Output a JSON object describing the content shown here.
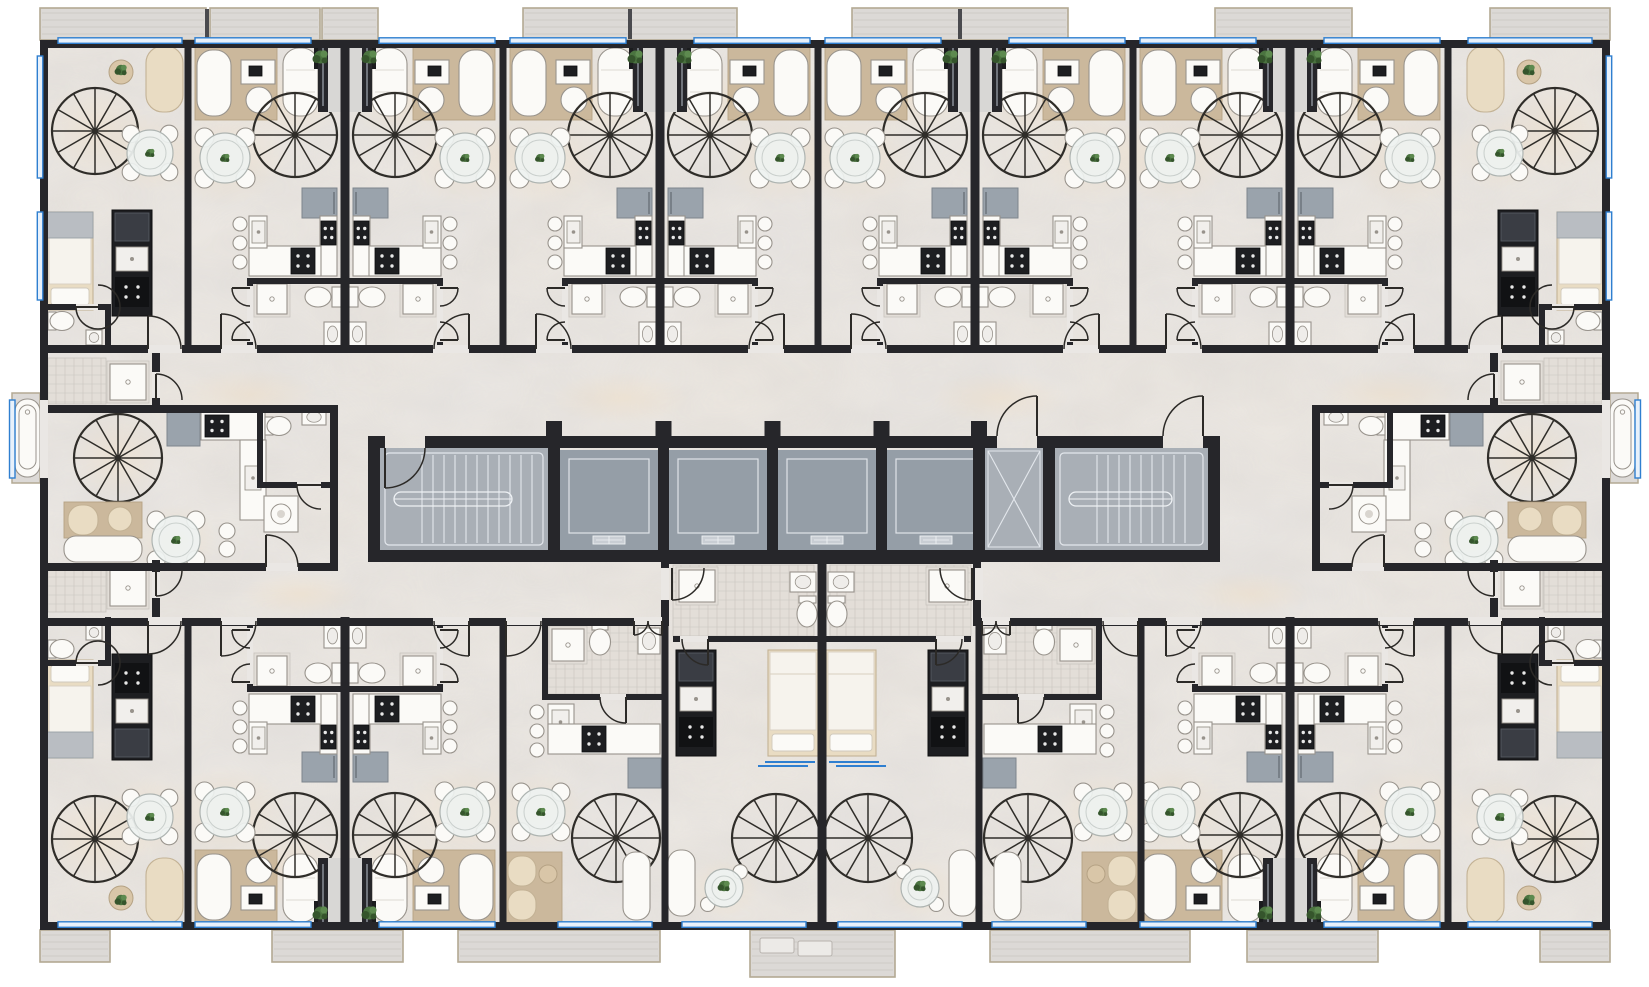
{
  "meta": {
    "domain": "architectural-floor-plan",
    "description": "Top-down 3D rendered floor plan of a residential apartment building: two wings of duplex studio units with spiral staircases, a central core with two stairwells, four elevators and a ventilation shaft, north and south corridors, perimeter balconies and two side bathtub bays",
    "text_in_image": "none"
  },
  "canvas": {
    "width": 1649,
    "height": 987
  },
  "palette": {
    "background": "#ffffff",
    "wall": "#26262a",
    "wall_light": "#3a3d44",
    "floor": "#eae7e4",
    "floor_warm": "#f2dfc4",
    "core_floor": "#a9afb6",
    "cab_floor": "#959ea7",
    "stair_tread": "#e3e7ec",
    "window_blue": "#2f7fd0",
    "window_fill": "#e8f1fb",
    "balcony_slab": "#dcd9d6",
    "balcony_edge": "#b3a993",
    "balcony_plank": "#cac6c2",
    "white": "#fbfaf7",
    "furn_stroke": "#98938c",
    "cream": "#e9dcc3",
    "cream_stroke": "#c3b295",
    "wood": "#cbb89c",
    "wood_stroke": "#b5a284",
    "appliance": "#1d1e21",
    "fridge": "#9aa3ac",
    "plant": "#4b7440",
    "plant_dark": "#35552c",
    "plant_lite": "#5d8a4f",
    "tile": "#e3ded8",
    "tile_line": "#c9c4be",
    "glass": "#eef2f0",
    "stair_stroke": "#2f2d29",
    "door_stroke": "#2c2a27"
  },
  "geometry": {
    "building": {
      "x0": 40,
      "x1": 1610,
      "y0": 40,
      "y1": 930,
      "outer_wall": 8
    },
    "mirror_axes": {
      "vertical": 825,
      "horizontal": 485,
      "narrow_pair": 822
    },
    "top_row": {
      "corner_left": {
        "x0": 45,
        "x1": 188
      },
      "pair_centers": [
        345,
        660,
        975,
        1290
      ],
      "boundary_walls": [
        188,
        503,
        818,
        1133,
        1448
      ],
      "unit_half_width": 157.5
    },
    "bottom_row": {
      "pair_centers": [
        345,
        1290
      ],
      "studio_left": {
        "x0": 503,
        "x1": 665
      },
      "narrow_left": {
        "x0": 665,
        "x1": 822
      },
      "boundary_walls": [
        188,
        503,
        665,
        979,
        1141,
        1448
      ],
      "bump": {
        "x0": 661,
        "x1": 981,
        "y0": 556
      }
    },
    "middle_unit_left": {
      "x0": 45,
      "x1": 330,
      "y0": 405,
      "y1": 571
    },
    "core": {
      "x0": 368,
      "x1": 1220,
      "y0": 436,
      "y1": 562,
      "wall": 12,
      "stairwell_left": {
        "x0": 380,
        "x1": 548
      },
      "elevator_bank": {
        "x0": 560,
        "x1": 985,
        "cab_count": 4,
        "divider": 11
      },
      "vent_shaft": {
        "x0": 985,
        "x1": 1043
      },
      "stairwell_right": {
        "x0": 1055,
        "x1": 1208
      },
      "door_gaps": [
        [
          385,
          425
        ],
        [
          997,
          1037
        ],
        [
          1163,
          1203
        ]
      ]
    },
    "corridors": {
      "north": {
        "y0": 353,
        "y1": 436
      },
      "south": {
        "y0": 571,
        "y1": 618
      }
    },
    "balconies": {
      "top_band": [
        8,
        40
      ],
      "bottom_band": [
        930,
        962
      ],
      "top": [
        [
          40,
          206
        ],
        [
          210,
          320
        ],
        [
          322,
          378
        ],
        [
          523,
          737
        ],
        [
          852,
          1068
        ],
        [
          1215,
          1352
        ],
        [
          1490,
          1610
        ]
      ],
      "bottom": [
        [
          40,
          110
        ],
        [
          272,
          403
        ],
        [
          458,
          660
        ],
        [
          750,
          895
        ],
        [
          990,
          1190
        ],
        [
          1247,
          1378
        ],
        [
          1540,
          1610
        ]
      ],
      "planter_balcony_bottom_index": 3
    },
    "side_bay_left": {
      "x0": 12,
      "x1": 40,
      "y0": 393,
      "y1": 483
    },
    "windows": {
      "top_wall": [
        [
          58,
          182
        ],
        [
          195,
          311
        ],
        [
          379,
          495
        ],
        [
          510,
          626
        ],
        [
          694,
          810
        ],
        [
          825,
          941
        ],
        [
          1009,
          1125
        ],
        [
          1140,
          1256
        ],
        [
          1324,
          1440
        ],
        [
          1468,
          1592
        ]
      ],
      "bottom_wall": [
        [
          58,
          182
        ],
        [
          195,
          311
        ],
        [
          379,
          495
        ],
        [
          558,
          652
        ],
        [
          682,
          806
        ],
        [
          838,
          962
        ],
        [
          992,
          1086
        ],
        [
          1140,
          1256
        ],
        [
          1324,
          1440
        ],
        [
          1468,
          1592
        ]
      ],
      "left_wall": [
        [
          56,
          178
        ],
        [
          212,
          300
        ]
      ],
      "bay_window_y": [
        400,
        478
      ]
    }
  },
  "inventory": {
    "apartment_units": 22,
    "spiral_staircases": 22,
    "elevators": 4,
    "stairwells": 2,
    "vent_shafts": 1,
    "bathtubs": 2,
    "balconies": 14,
    "kitchens": 22,
    "bathrooms": 24
  }
}
